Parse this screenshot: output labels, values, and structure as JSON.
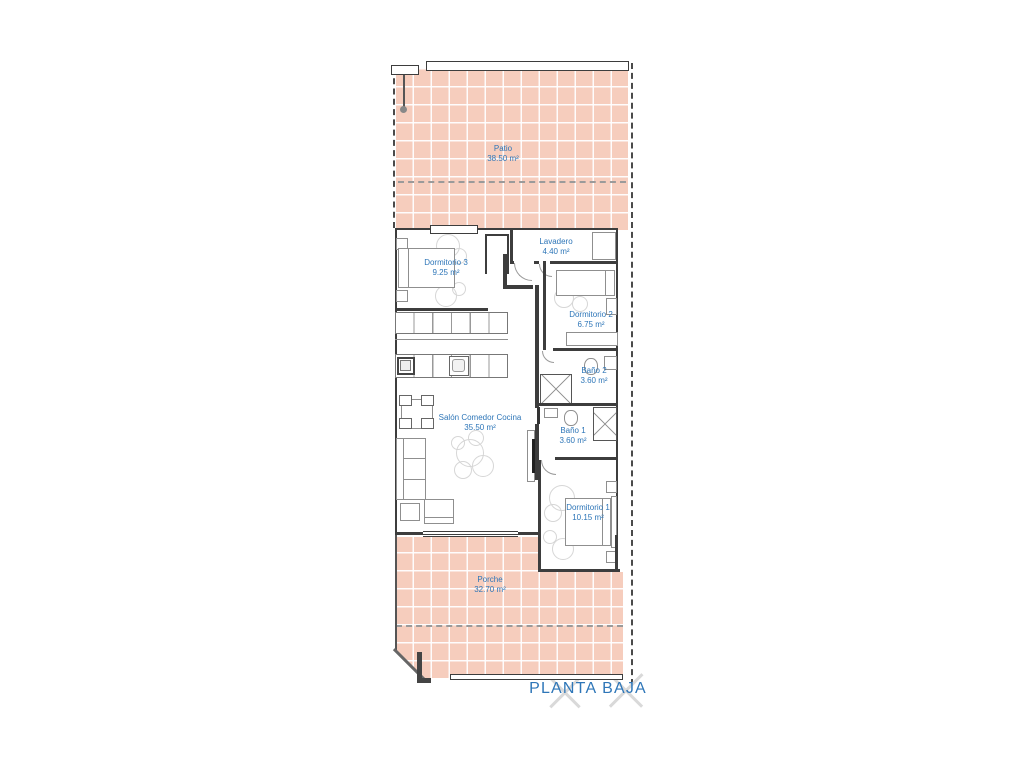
{
  "title": "PLANTA BAJA",
  "rooms": [
    {
      "id": "patio",
      "name": "Patio",
      "area": "38.50 m²"
    },
    {
      "id": "dormitorio-3",
      "name": "Dormitorio 3",
      "area": "9.25 m²"
    },
    {
      "id": "lavadero",
      "name": "Lavadero",
      "area": "4.40 m²"
    },
    {
      "id": "dormitorio-2",
      "name": "Dormitorio 2",
      "area": "6.75 m²"
    },
    {
      "id": "bano-2",
      "name": "Baño 2",
      "area": "3.60 m²"
    },
    {
      "id": "bano-1",
      "name": "Baño 1",
      "area": "3.60 m²"
    },
    {
      "id": "salon",
      "name": "Salón Comedor Cocina",
      "area": "35.50 m²"
    },
    {
      "id": "dormitorio-1",
      "name": "Dormitorio 1",
      "area": "10.15 m²"
    },
    {
      "id": "porche",
      "name": "Porche",
      "area": "32.70 m²"
    }
  ],
  "colors": {
    "background": "#ffffff",
    "tile_fill": "#f6cdbd",
    "tile_grid": "#ffffff",
    "label_text": "#2e76b8",
    "wall": "#3d3d3d",
    "furniture_outline": "#8f8f8f",
    "plant_outline": "#d6d6d6",
    "boundary_dash": "#4a4a4a",
    "cross_mark": "#d9d9d9"
  }
}
